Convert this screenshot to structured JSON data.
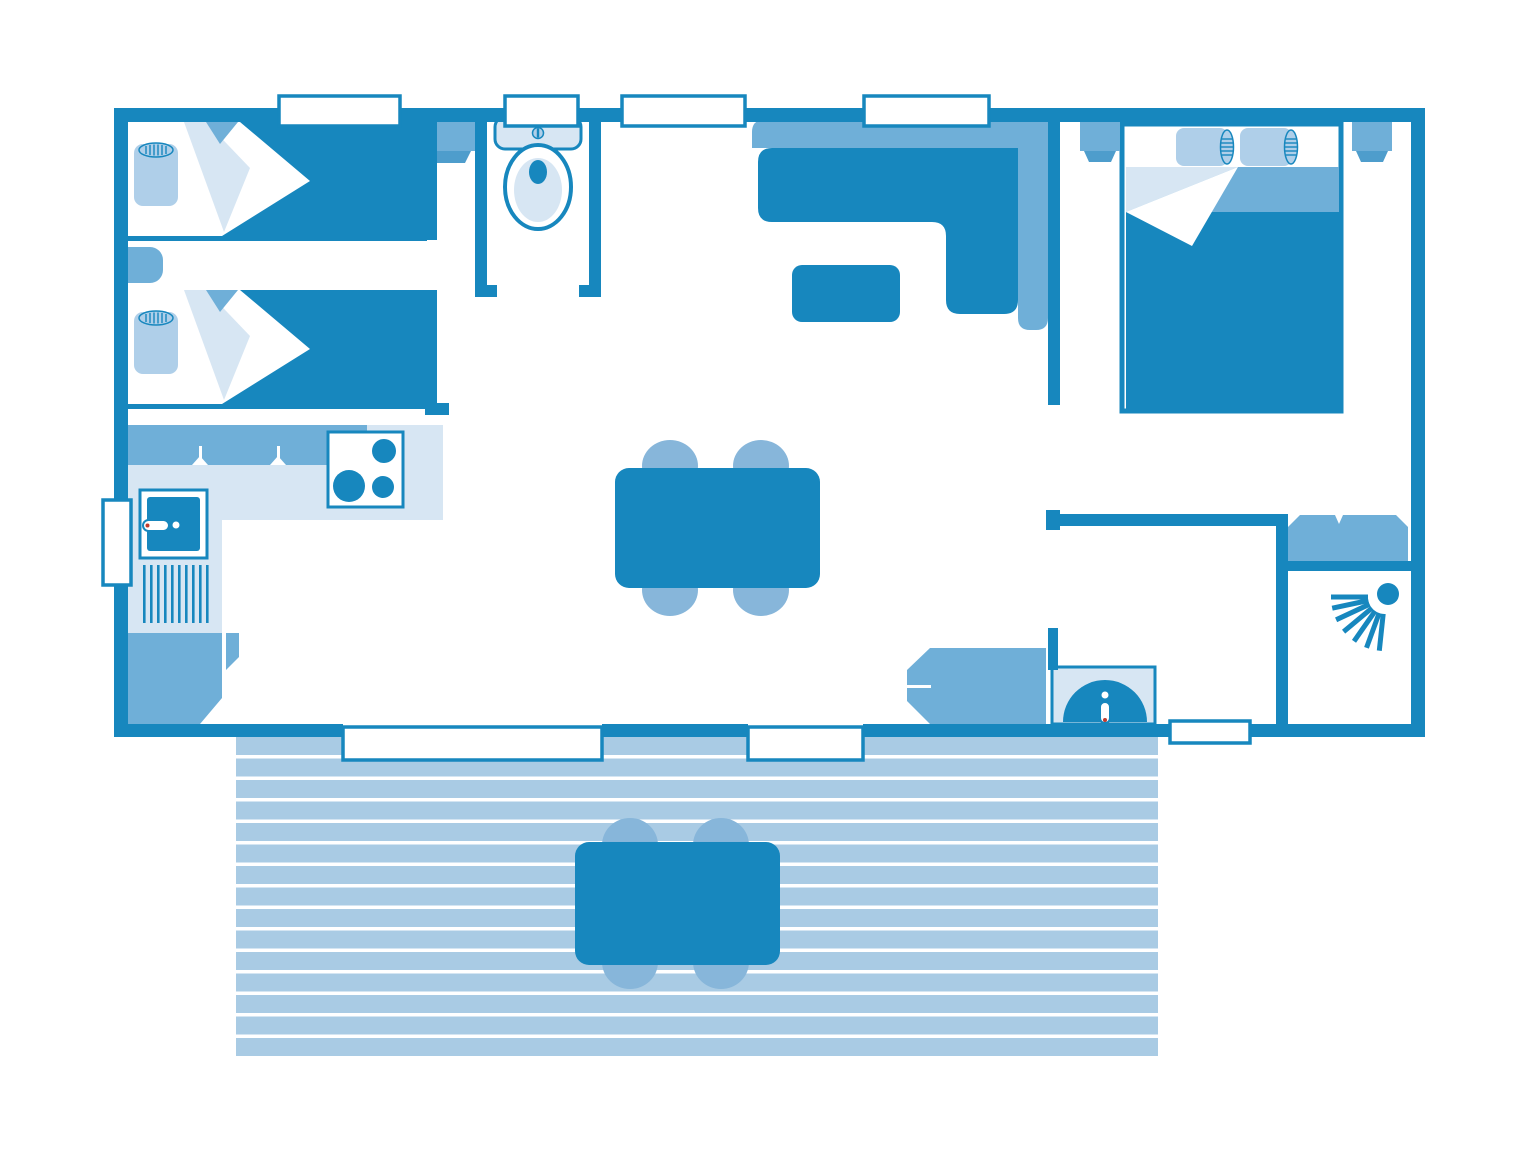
{
  "meta": {
    "kind": "floorplan-diagram",
    "canvas": {
      "width": 1536,
      "height": 1152
    }
  },
  "colors": {
    "wall": "#1787BE",
    "medium": "#6FAFD8",
    "chair": "#87B6DA",
    "plank": "#A9CBE4",
    "pale": "#D7E6F3",
    "pillow": "#AFCFE9",
    "lip": "#4E9DCC",
    "accent_red": "#C0392B",
    "white": "#FFFFFF"
  },
  "plan": {
    "rooms": [
      {
        "name": "twin-bedroom",
        "furniture": [
          "single-bed",
          "single-bed",
          "nightstand",
          "wardrobe"
        ]
      },
      {
        "name": "wc",
        "furniture": [
          "toilet"
        ]
      },
      {
        "name": "living-room",
        "furniture": [
          "corner-sofa",
          "coffee-table",
          "dining-table",
          "dining-chair",
          "dining-chair",
          "dining-chair",
          "dining-chair"
        ]
      },
      {
        "name": "kitchen",
        "furniture": [
          "counter",
          "hob-3-burners",
          "sink",
          "drainer",
          "base-cabinet"
        ]
      },
      {
        "name": "double-bedroom",
        "furniture": [
          "double-bed",
          "nightstand",
          "nightstand"
        ]
      },
      {
        "name": "hallway",
        "furniture": [
          "dresser",
          "washbasin"
        ]
      },
      {
        "name": "shower-room",
        "furniture": [
          "vanity-unit",
          "shower"
        ]
      },
      {
        "name": "terrace",
        "furniture": [
          "outdoor-table",
          "outdoor-chair",
          "outdoor-chair",
          "outdoor-chair",
          "outdoor-chair"
        ]
      }
    ],
    "openings": {
      "top_windows": 4,
      "left_windows": 1,
      "bottom_openings": 3
    }
  }
}
